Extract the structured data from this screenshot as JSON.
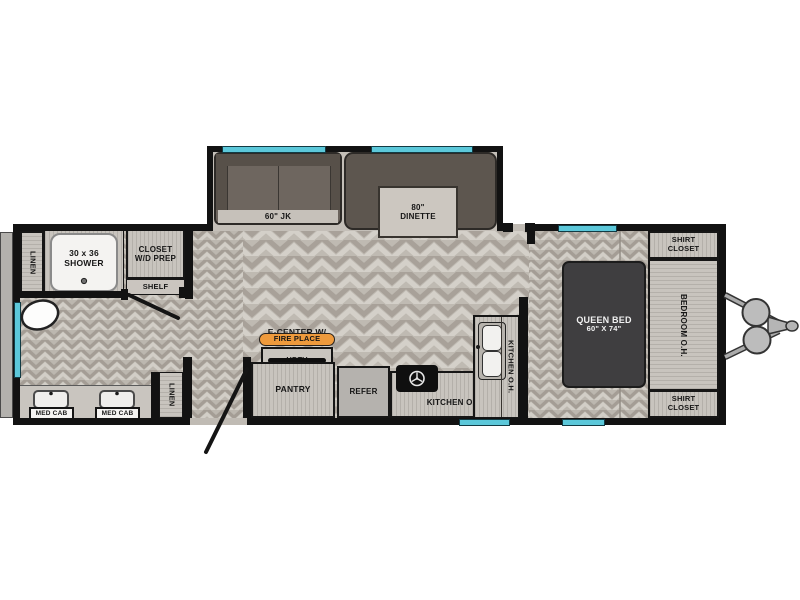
{
  "title": "travel-trailer-floorplan",
  "colors": {
    "wall": "#121212",
    "window": "#5cc8da",
    "floor_base": "#bfbab2",
    "cabinet": "#c8c4be",
    "sofa": "#6b635c",
    "bed": "#3f3e40",
    "fireplace_accent": "#ee9a3c",
    "refer": "#b5b2ae"
  },
  "rooms": {
    "linen_top": {
      "label": "LINEN"
    },
    "linen_bottom": {
      "label": "LINEN"
    },
    "shower": {
      "size": "30 x 36",
      "name": "SHOWER"
    },
    "closet_wd": {
      "line1": "CLOSET",
      "line2": "W/D PREP"
    },
    "shelf": {
      "label": "SHELF"
    },
    "vanity": {
      "med_cab_left": "MED CAB",
      "med_cab_right": "MED CAB"
    },
    "sofa": {
      "label": "60\" JK"
    },
    "dinette": {
      "size": "80\"",
      "name": "DINETTE"
    },
    "entertainment": {
      "title": "E-CENTER W/",
      "fireplace": "FIRE PLACE",
      "tv": "HDTV"
    },
    "pantry": {
      "label": "PANTRY"
    },
    "refer": {
      "label": "REFER"
    },
    "kitchen": {
      "overhead": "KITCHEN O.H.",
      "overhead_vert": "KITCHEN O.H."
    },
    "bed": {
      "line1": "QUEEN BED",
      "line2": "60\" X 74\""
    },
    "bedroom_oh": {
      "label": "BEDROOM O.H."
    },
    "shirt_closet_top": {
      "line1": "SHIRT",
      "line2": "CLOSET"
    },
    "shirt_closet_bottom": {
      "line1": "SHIRT",
      "line2": "CLOSET"
    }
  }
}
